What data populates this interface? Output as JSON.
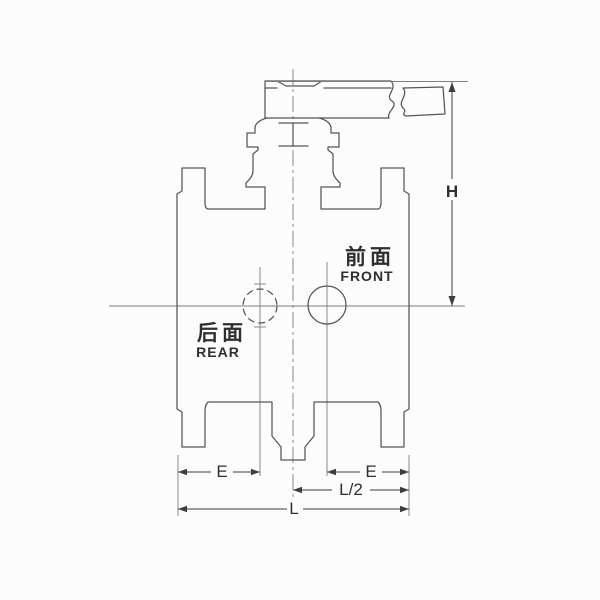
{
  "labels": {
    "front_zh": "前面",
    "front_en": "FRONT",
    "rear_zh": "后面",
    "rear_en": "REAR"
  },
  "dimensions": {
    "height": "H",
    "e_left": "E",
    "e_right": "E",
    "half_length": "L/2",
    "length": "L"
  },
  "colors": {
    "background": "#fcfcfc",
    "line": "#555555",
    "dimension": "#3d3d3d",
    "text": "#2f2f2f"
  }
}
